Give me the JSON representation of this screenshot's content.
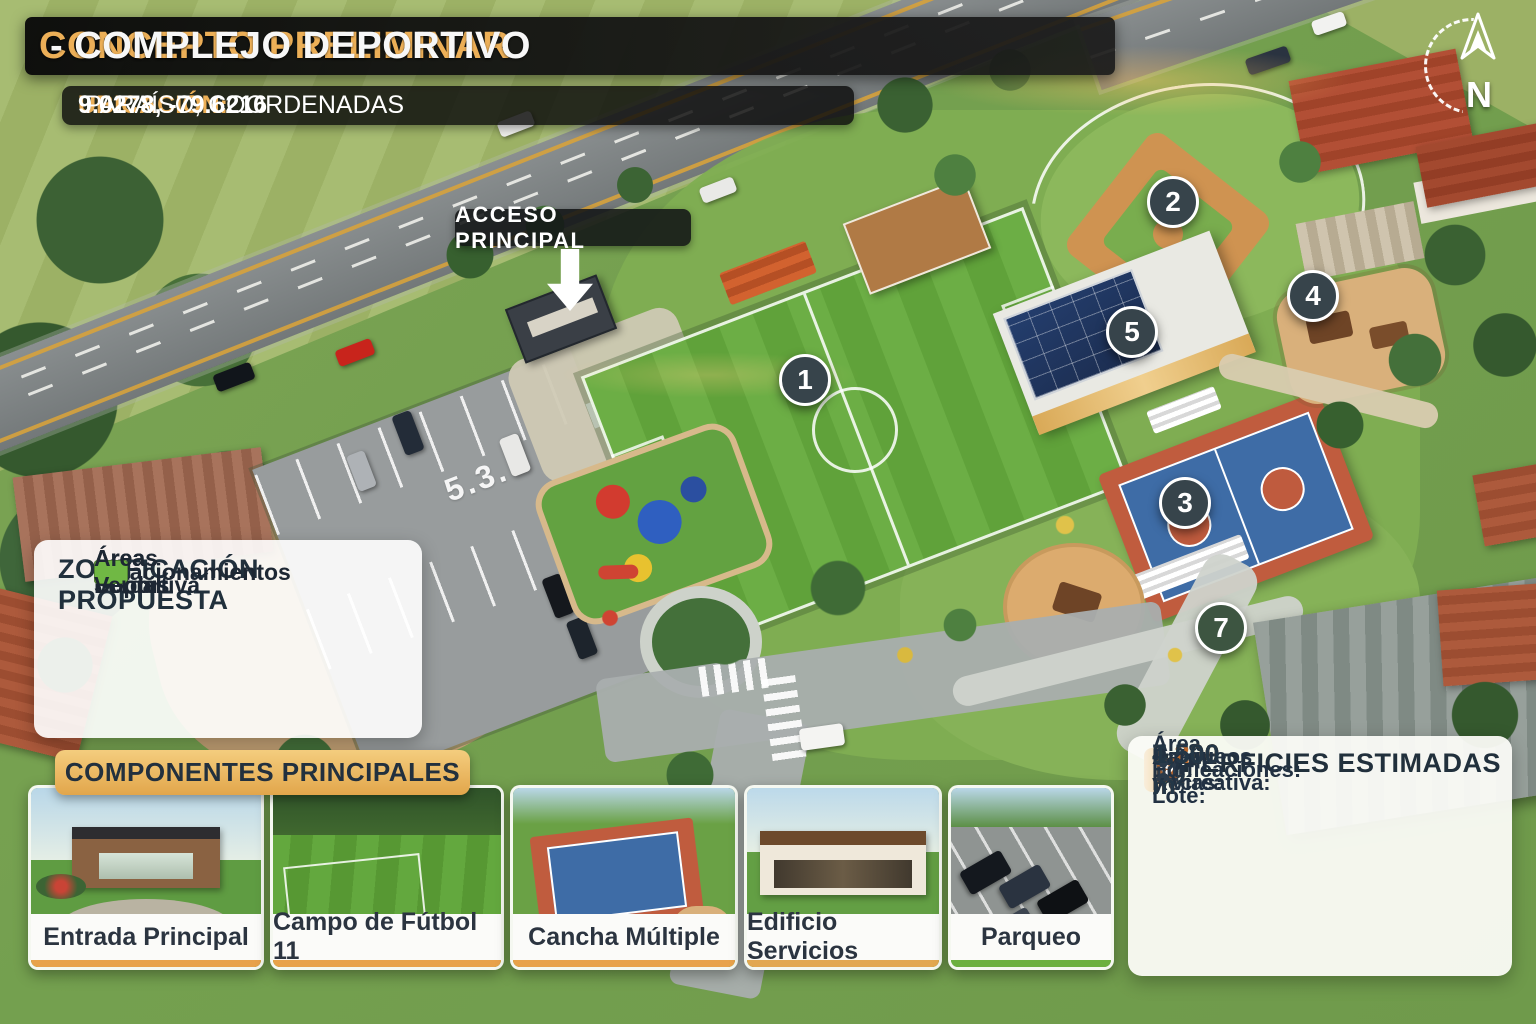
{
  "header": {
    "title_highlight": "CONCEPTO PRELIMINAR",
    "title_rest": " - COMPLEJO DEPORTIVO",
    "location_label": "UBICACIÓN:",
    "location_place": " PARAÍSO, COORDENADAS ",
    "location_coords": "9.0278, -79.6216"
  },
  "compass": {
    "north_letter": "N"
  },
  "map": {
    "access_label": "ACCESO PRINCIPAL",
    "ground_marking": "5.3.",
    "markers": [
      {
        "number": "1",
        "color": "#37444b"
      },
      {
        "number": "2",
        "color": "#37444b"
      },
      {
        "number": "3",
        "color": "#37444b"
      },
      {
        "number": "4",
        "color": "#37444b"
      },
      {
        "number": "5",
        "color": "#37444b"
      },
      {
        "number": "7",
        "color": "#3d5541"
      }
    ]
  },
  "legend": {
    "title": "ZONIFICACIÓN PROPUESTA",
    "items": [
      {
        "label": "Área Deportiva",
        "color": "#93c3a4"
      },
      {
        "label": "Área Social",
        "color": "#f49f3f"
      },
      {
        "label": "Estacionamientos",
        "color": "#9b9ba6"
      },
      {
        "label": "Áreas Verdes",
        "color": "#70b844"
      }
    ]
  },
  "components": {
    "title": "COMPONENTES PRINCIPALES",
    "cards": [
      {
        "caption": "Entrada Principal",
        "accent": "#e8a24a"
      },
      {
        "caption": "Campo de Fútbol 11",
        "accent": "#e8a24a"
      },
      {
        "caption": "Cancha Múltiple",
        "accent": "#e8a24a"
      },
      {
        "caption": "Edificio Servicios",
        "accent": "#e2a851"
      },
      {
        "caption": "Parqueo",
        "accent": "#6cb03f"
      }
    ]
  },
  "surfaces": {
    "title": "SUPERFICIES ESTIMADAS",
    "rows": [
      {
        "icon": "land-layers-icon",
        "label": "Área del Lote:",
        "value": "7,200 m²",
        "value_color": "#233646",
        "highlight": false
      },
      {
        "icon": "recreation-area-icon",
        "label": "Área Recreativa:",
        "value": "4,500 m²",
        "value_color": "#233646",
        "highlight": true
      },
      {
        "icon": "buildings-icon",
        "label": "Edificaciones:",
        "value": "1,200 m²",
        "value_color": "#c0692b",
        "highlight": false
      },
      {
        "icon": "parking-roads-icon",
        "label": "Parqueos y Vías:",
        "value": "1,500 m²",
        "value_color": "#233646",
        "highlight": false
      }
    ]
  }
}
